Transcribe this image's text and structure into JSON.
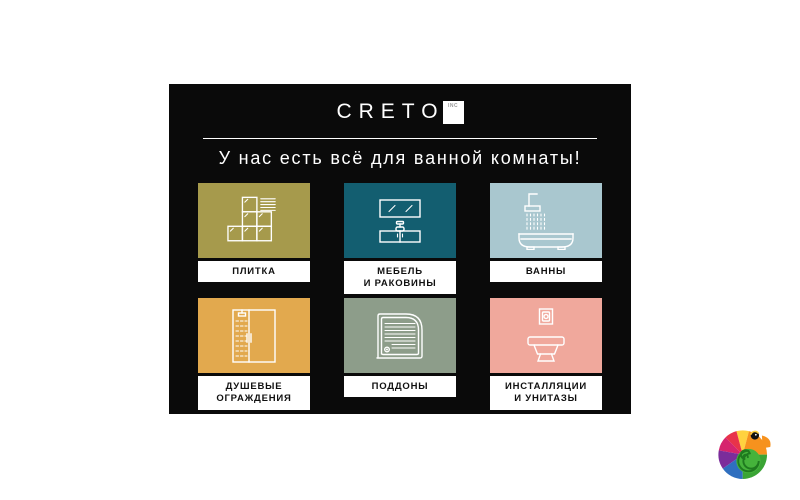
{
  "page": {
    "background": "#ffffff"
  },
  "card": {
    "background": "#0a0a0a"
  },
  "logo": {
    "text": "CRETO",
    "badge_text": "INC"
  },
  "headline": "У нас есть всё для ванной комнаты!",
  "categories": [
    {
      "label": "ПЛИТКА",
      "color": "#a69a4c",
      "icon": "tiles-icon"
    },
    {
      "label": "МЕБЕЛЬ\nИ РАКОВИНЫ",
      "color": "#135e70",
      "icon": "mirror-vanity-icon"
    },
    {
      "label": "ВАННЫ",
      "color": "#a9c7cf",
      "icon": "bathtub-shower-icon"
    },
    {
      "label": "ДУШЕВЫЕ\nОГРАЖДЕНИЯ",
      "color": "#e2a94e",
      "icon": "shower-enclosure-icon"
    },
    {
      "label": "ПОДДОНЫ",
      "color": "#8d9d8a",
      "icon": "shower-tray-icon"
    },
    {
      "label": "ИНСТАЛЛЯЦИИ\nИ УНИТАЗЫ",
      "color": "#f0a89c",
      "icon": "toilet-installation-icon"
    }
  ],
  "watermark": {
    "icon": "chameleon-logo"
  }
}
